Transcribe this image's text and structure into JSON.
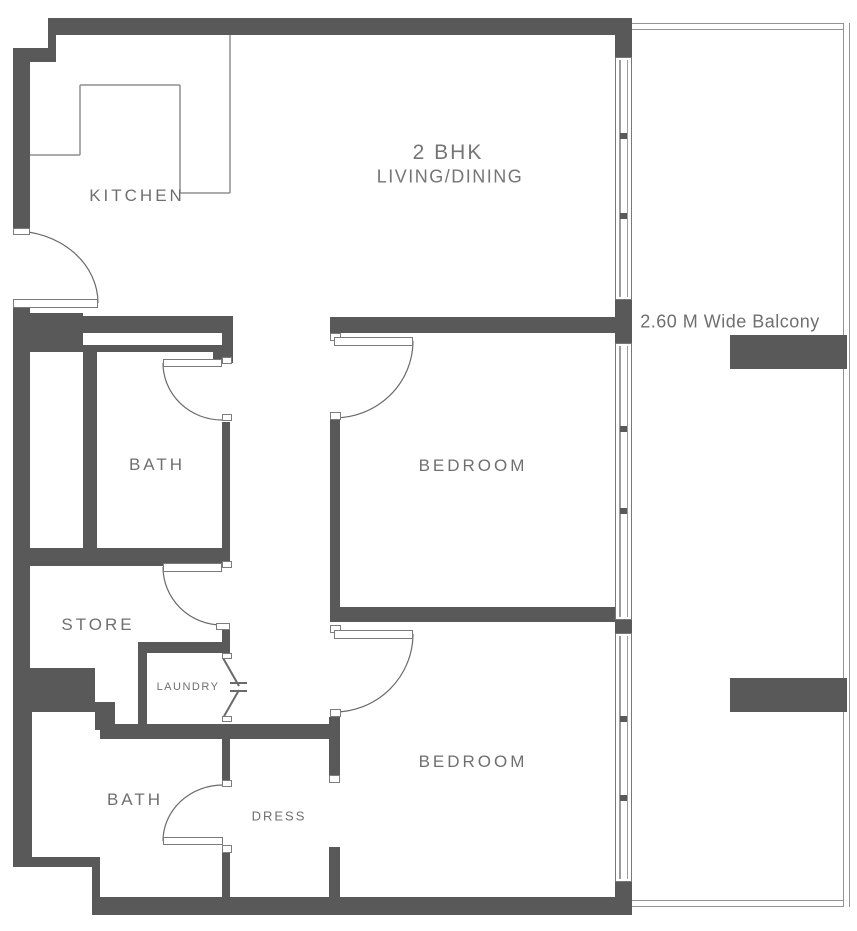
{
  "title": "2 BHK Floor Plan",
  "colors": {
    "wall": "#595959",
    "thin_line": "#8f8f8f",
    "label": "#6f6f6f",
    "arc": "#6a6a6a",
    "door_border": "#7a7a7a"
  },
  "labels": {
    "kitchen": {
      "text": "KITCHEN",
      "x": 137,
      "y": 196,
      "class": "room"
    },
    "unit": {
      "text": "2 BHK",
      "x": 448,
      "y": 153,
      "class": "title-big"
    },
    "living": {
      "text": "LIVING/DINING",
      "x": 450,
      "y": 177,
      "class": "title-sub"
    },
    "balcony": {
      "text": "2.60 M Wide Balcony",
      "x": 730,
      "y": 322,
      "class": "balcony"
    },
    "bath1": {
      "text": "BATH",
      "x": 157,
      "y": 465,
      "class": "room"
    },
    "bedroom1": {
      "text": "BEDROOM",
      "x": 473,
      "y": 466,
      "class": "room"
    },
    "store": {
      "text": "STORE",
      "x": 98,
      "y": 625,
      "class": "room"
    },
    "laundry": {
      "text": "LAUNDRY",
      "x": 188,
      "y": 687,
      "class": "small"
    },
    "bedroom2": {
      "text": "BEDROOM",
      "x": 473,
      "y": 762,
      "class": "room"
    },
    "bath2": {
      "text": "BATH",
      "x": 135,
      "y": 800,
      "class": "room"
    },
    "dress": {
      "text": "DRESS",
      "x": 279,
      "y": 816,
      "class": "dress"
    }
  },
  "floorplan": {
    "width": 857,
    "height": 931,
    "walls": [
      [
        48,
        18,
        584,
        17
      ],
      [
        48,
        35,
        8,
        18
      ],
      [
        13,
        48,
        43,
        14
      ],
      [
        13,
        48,
        17,
        184
      ],
      [
        13,
        305,
        17,
        243
      ],
      [
        13,
        313,
        70,
        39
      ],
      [
        83,
        316,
        130,
        17
      ],
      [
        83,
        345,
        139,
        7
      ],
      [
        213,
        316,
        20,
        47
      ],
      [
        83,
        348,
        14,
        200
      ],
      [
        13,
        548,
        217,
        18
      ],
      [
        13,
        566,
        17,
        102
      ],
      [
        13,
        668,
        82,
        44
      ],
      [
        95,
        702,
        20,
        28
      ],
      [
        13,
        712,
        19,
        155
      ],
      [
        13,
        857,
        87,
        10
      ],
      [
        92,
        857,
        8,
        56
      ],
      [
        92,
        897,
        540,
        18
      ],
      [
        100,
        724,
        238,
        15
      ],
      [
        138,
        642,
        9,
        82
      ],
      [
        138,
        642,
        92,
        11
      ],
      [
        222,
        548,
        8,
        20
      ],
      [
        222,
        623,
        8,
        30
      ],
      [
        222,
        422,
        8,
        126
      ],
      [
        222,
        739,
        8,
        48
      ],
      [
        222,
        845,
        8,
        52
      ],
      [
        330,
        317,
        285,
        16
      ],
      [
        330,
        417,
        10,
        190
      ],
      [
        330,
        607,
        285,
        15
      ],
      [
        329,
        717,
        11,
        66
      ],
      [
        329,
        847,
        11,
        51
      ],
      [
        615,
        18,
        17,
        39
      ],
      [
        615,
        300,
        17,
        43
      ],
      [
        615,
        620,
        17,
        13
      ],
      [
        615,
        882,
        17,
        33
      ],
      [
        730,
        335,
        117,
        34
      ],
      [
        730,
        678,
        117,
        34
      ]
    ],
    "white_slots": [
      [
        97,
        333,
        125,
        12
      ]
    ],
    "markers": [
      [
        13,
        228,
        17,
        7
      ],
      [
        222,
        357,
        10,
        7
      ],
      [
        222,
        414,
        10,
        7
      ],
      [
        330,
        333,
        11,
        8
      ],
      [
        330,
        412,
        11,
        8
      ],
      [
        222,
        561,
        10,
        7
      ],
      [
        216,
        623,
        14,
        7
      ],
      [
        330,
        625,
        11,
        8
      ],
      [
        330,
        709,
        11,
        8
      ],
      [
        222,
        780,
        10,
        7
      ],
      [
        222,
        845,
        10,
        8
      ],
      [
        222,
        653,
        10,
        6
      ],
      [
        222,
        716,
        10,
        6
      ],
      [
        329,
        775,
        11,
        8
      ]
    ],
    "balcony_edges": [
      {
        "x": 632,
        "y": 23,
        "w": 211,
        "h": 7,
        "dir": "h"
      },
      {
        "x": 843,
        "y": 23,
        "w": 7,
        "h": 884,
        "dir": "v"
      },
      {
        "x": 632,
        "y": 900,
        "w": 211,
        "h": 7,
        "dir": "h"
      }
    ],
    "windows": [
      {
        "x": 615,
        "y": 57,
        "w": 17,
        "h": 243,
        "ticks": [
          135,
          215
        ]
      },
      {
        "x": 615,
        "y": 343,
        "w": 17,
        "h": 277,
        "ticks": [
          428,
          510
        ]
      },
      {
        "x": 615,
        "y": 633,
        "w": 17,
        "h": 249,
        "ticks": [
          718,
          797
        ]
      }
    ],
    "door_leaves": [
      [
        13,
        299,
        85,
        9
      ],
      [
        163,
        359,
        59,
        8
      ],
      [
        163,
        563,
        59,
        9
      ],
      [
        163,
        837,
        60,
        8
      ],
      [
        334,
        337,
        79,
        9
      ],
      [
        334,
        630,
        79,
        9
      ]
    ],
    "door_arcs": [
      "M 98 303 A 84 72 0 0 0 14 231",
      "M 163 363 A 59 57 0 0 0 222 420",
      "M 163 567 A 59 58 0 0 0 222 625",
      "M 163 841 A 60 56 0 0 1 223 785",
      "M 413 341 A 79 77 0 0 1 334 418",
      "M 413 634 A 79 78 0 0 1 334 712"
    ],
    "bifold_path": "M 223 658 L 239 686 M 239 690 L 223 718 M 230 683 L 247 683 M 230 691 L 247 691",
    "counter_lines": [
      [
        30,
        155,
        80,
        155
      ],
      [
        80,
        85,
        80,
        155
      ],
      [
        80,
        85,
        180,
        85
      ],
      [
        180,
        85,
        180,
        193
      ],
      [
        180,
        193,
        230,
        193
      ],
      [
        230,
        35,
        230,
        193
      ]
    ]
  }
}
